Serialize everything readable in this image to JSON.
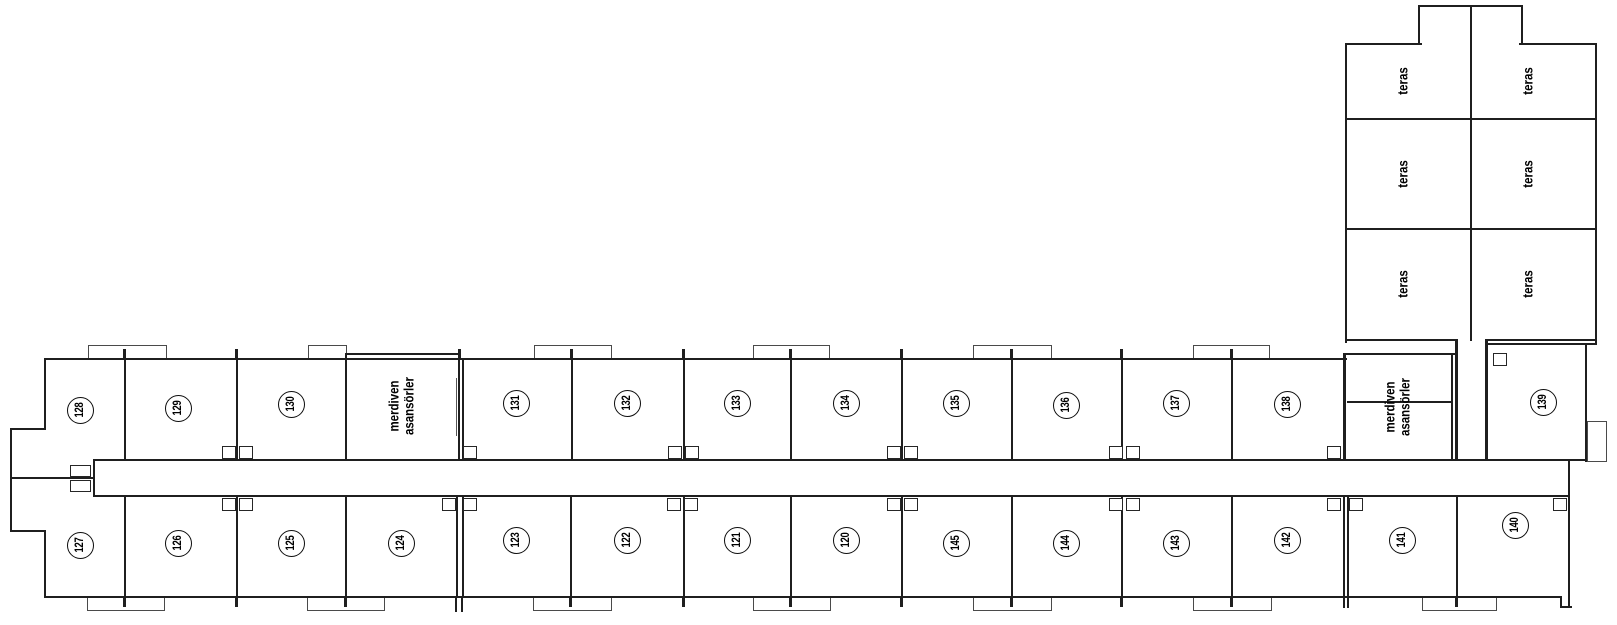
{
  "plan": {
    "background_color": "#ffffff",
    "wall_color": "#1f1f1f",
    "rooms_top": [
      "128",
      "129",
      "130",
      "131",
      "132",
      "133",
      "134",
      "135",
      "136",
      "137",
      "138",
      "139"
    ],
    "rooms_bottom": [
      "127",
      "126",
      "125",
      "124",
      "123",
      "122",
      "121",
      "120",
      "145",
      "144",
      "143",
      "142",
      "141",
      "140"
    ],
    "stairs_label_line1": "merdiven",
    "stairs_label_line2": "asansörler",
    "terrace_label": "teras"
  }
}
